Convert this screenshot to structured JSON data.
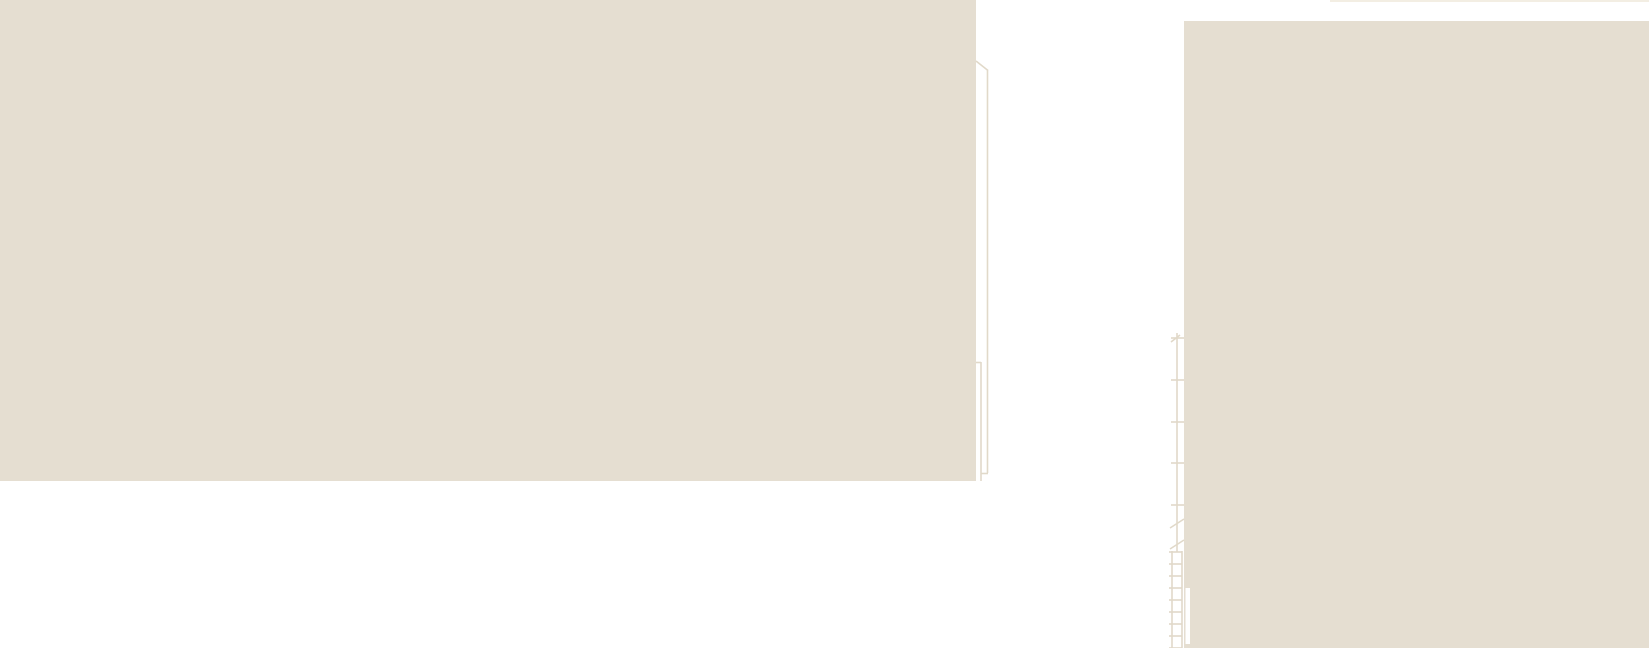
{
  "canvas": {
    "width": 1649,
    "height": 648,
    "background_color": "#ffffff"
  },
  "palette": {
    "mass_fill": "#e5ded1",
    "line_color": "#e1d9c9",
    "faint_line_color": "#f3eee3",
    "notch_color": "#ffffff"
  },
  "drawing": {
    "blocks": [
      {
        "name": "left-building-mass",
        "x": 0,
        "y": 0,
        "w": 976,
        "h": 481
      },
      {
        "name": "right-building-mass",
        "x": 1184,
        "y": 21,
        "w": 465,
        "h": 627
      }
    ],
    "faint_strips": [
      {
        "name": "top-edge-faint-line",
        "x": 1330,
        "y": 0,
        "w": 319,
        "h": 2
      }
    ],
    "segments": [
      {
        "name": "left-parapet-step-diagonal",
        "x1": 976,
        "y1": 61,
        "x2": 988,
        "y2": 70.5
      },
      {
        "name": "left-wall-outline-vertical",
        "x1": 987.5,
        "y1": 70,
        "x2": 987.5,
        "y2": 473
      },
      {
        "name": "left-wall-outline-foot",
        "x1": 981,
        "y1": 473.5,
        "x2": 988,
        "y2": 473.5
      },
      {
        "name": "left-wall-inner-vertical",
        "x1": 981,
        "y1": 362,
        "x2": 981,
        "y2": 481
      },
      {
        "name": "left-wall-inner-tick",
        "x1": 976,
        "y1": 362.5,
        "x2": 981,
        "y2": 362.5
      },
      {
        "name": "dimension-line-vertical",
        "x1": 1177,
        "y1": 337,
        "x2": 1177,
        "y2": 552
      },
      {
        "name": "dimension-line-top-stub",
        "x1": 1177,
        "y1": 333,
        "x2": 1177,
        "y2": 338
      },
      {
        "name": "dimension-top-slash",
        "x1": 1171,
        "y1": 342,
        "x2": 1180,
        "y2": 335
      },
      {
        "name": "break-mark-upper-diagonal",
        "x1": 1170,
        "y1": 528,
        "x2": 1184,
        "y2": 519
      },
      {
        "name": "break-mark-lower-diagonal",
        "x1": 1170,
        "y1": 549,
        "x2": 1184,
        "y2": 540
      }
    ],
    "dimension_ticks": {
      "x1": 1171,
      "x2": 1184,
      "ys": [
        338,
        380,
        422,
        463,
        505
      ]
    },
    "ladder": {
      "rail_left_x": 1172,
      "rail_right_x": 1182,
      "top": 551,
      "bottom": 648,
      "rung_x1": 1169,
      "rung_x2": 1182,
      "rung_start_y": 552,
      "rung_step": 12,
      "rung_count": 9
    },
    "white_notches": [
      {
        "name": "right-mass-left-groove",
        "x": 1185.5,
        "y": 588,
        "w": 4.5,
        "h": 56
      }
    ]
  }
}
